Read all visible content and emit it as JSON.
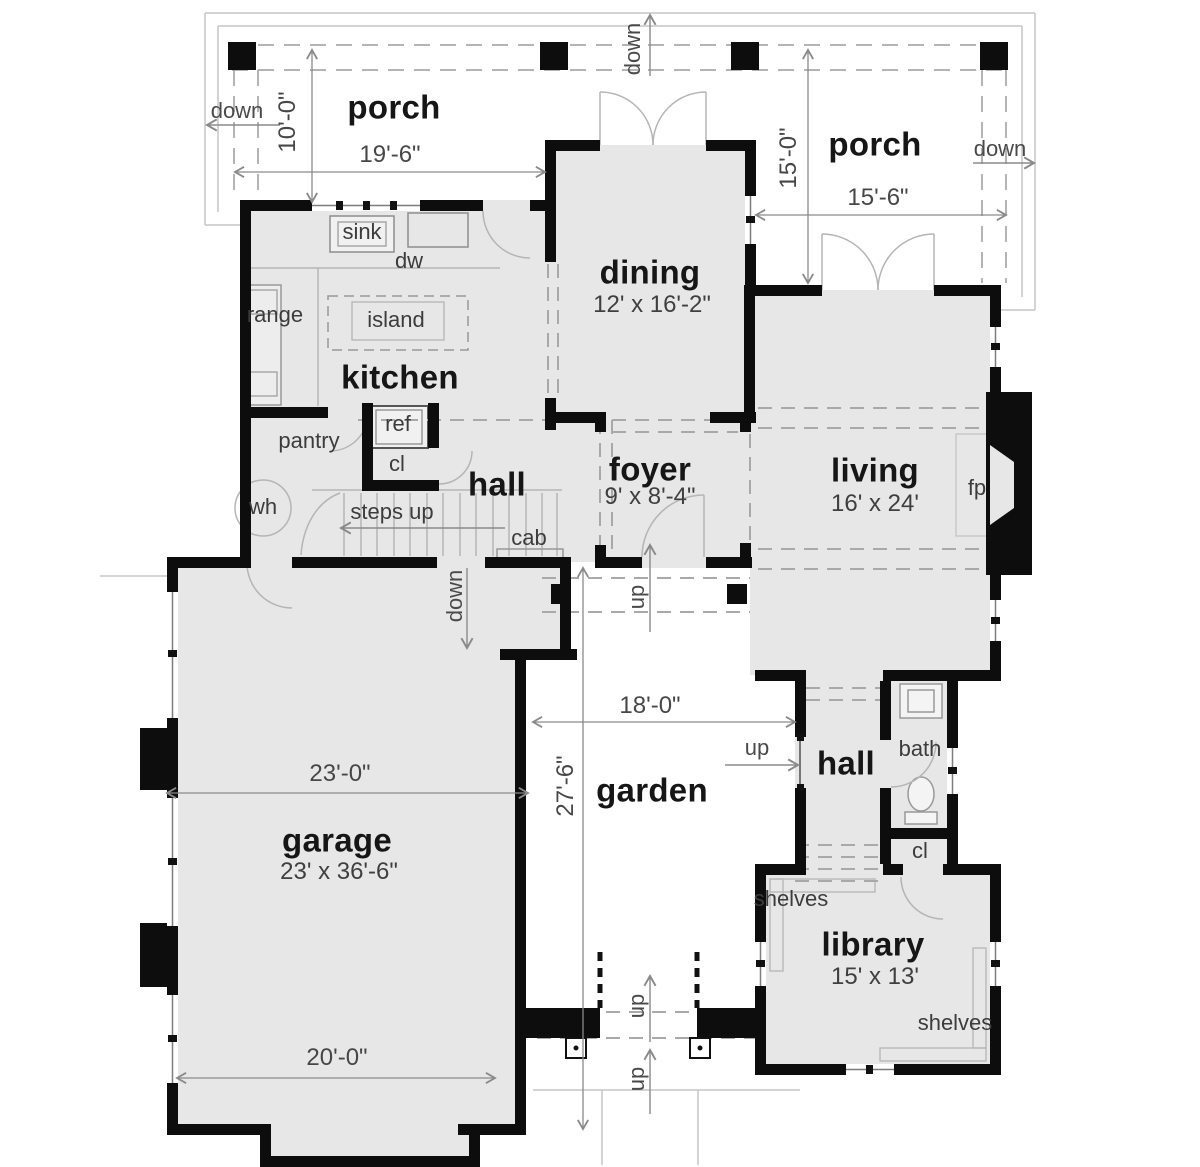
{
  "colors": {
    "wall": "#0d0d0d",
    "room_fill": "#e7e7e7",
    "thin_line": "#b5b5b5",
    "dashed_line": "#9c9c9c",
    "dim_line": "#8a8a8a",
    "text": "#3c3c3c",
    "bold_text": "#161616"
  },
  "rooms": {
    "porch_left": {
      "name": "porch",
      "width": "19'-6\"",
      "depth": "10'-0\""
    },
    "porch_right": {
      "name": "porch",
      "width": "15'-6\"",
      "depth": "15'-0\""
    },
    "kitchen": {
      "name": "kitchen"
    },
    "dining": {
      "name": "dining",
      "size": "12' x 16'-2\""
    },
    "foyer": {
      "name": "foyer",
      "size": "9' x 8'-4\""
    },
    "hall_main": {
      "name": "hall"
    },
    "living": {
      "name": "living",
      "size": "16' x 24'"
    },
    "garage": {
      "name": "garage",
      "size": "23' x 36'-6\"",
      "width_top": "23'-0\"",
      "width_bottom": "20'-0\""
    },
    "garden": {
      "name": "garden",
      "width": "18'-0\"",
      "depth": "27'-6\""
    },
    "hall_rear": {
      "name": "hall"
    },
    "bath": {
      "name": "bath"
    },
    "library": {
      "name": "library",
      "size": "15' x 13'"
    }
  },
  "fixtures": {
    "sink": "sink",
    "dw": "dw",
    "range": "range",
    "island": "island",
    "pantry": "pantry",
    "ref": "ref",
    "closet": "cl",
    "water_heater": "wh",
    "steps_up": "steps up",
    "cab": "cab",
    "fireplace": "fp",
    "shelves": "shelves"
  },
  "flow": {
    "up": "up",
    "down": "down"
  }
}
